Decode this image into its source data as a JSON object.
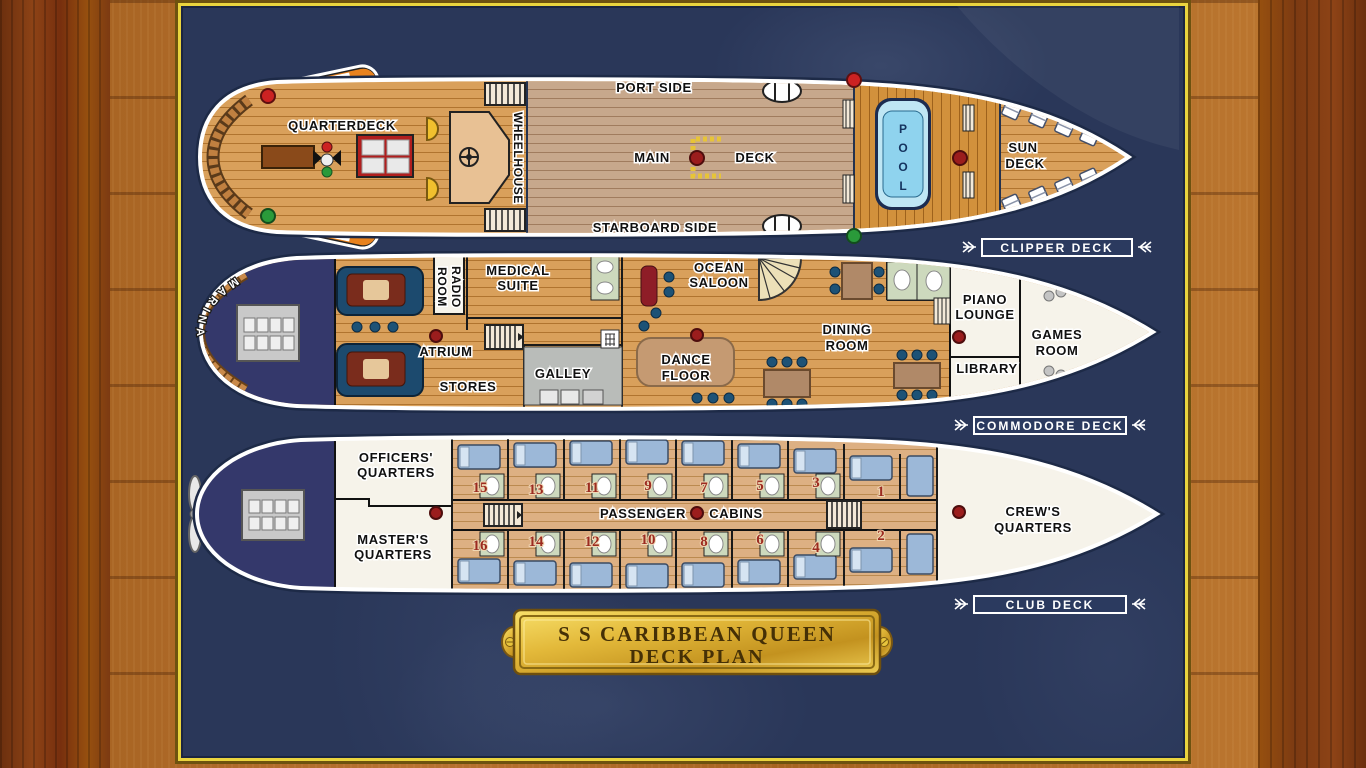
{
  "plaque": {
    "line1": "S S CARIBBEAN QUEEN",
    "line2": "DECK PLAN"
  },
  "decks": {
    "clipper": {
      "tag": "CLIPPER DECK",
      "labels": {
        "quarterdeck": "QUARTERDECK",
        "wheelhouse": "WHEELHOUSE",
        "port_side": "PORT SIDE",
        "starboard_side": "STARBOARD SIDE",
        "main": "MAIN",
        "deck": "DECK",
        "pool": "POOL",
        "sun": "SUN",
        "sun2": "DECK",
        "lifeboat1": "LIFE",
        "lifeboat2": "BOAT"
      }
    },
    "commodore": {
      "tag": "COMMODORE DECK",
      "labels": {
        "marina": "MARINA",
        "radio": [
          "RADIO",
          "ROOM"
        ],
        "medical": [
          "MEDICAL",
          "SUITE"
        ],
        "atrium": "ATRIUM",
        "stores": "STORES",
        "galley": "GALLEY",
        "ocean_saloon": [
          "OCEAN",
          "SALOON"
        ],
        "dance_floor": [
          "DANCE",
          "FLOOR"
        ],
        "dining_room": [
          "DINING",
          "ROOM"
        ],
        "piano_lounge": [
          "PIANO",
          "LOUNGE"
        ],
        "library": "LIBRARY",
        "games_room": [
          "GAMES",
          "ROOM"
        ]
      }
    },
    "club": {
      "tag": "CLUB DECK",
      "labels": {
        "officers": [
          "OFFICERS'",
          "QUARTERS"
        ],
        "masters": [
          "MASTER'S",
          "QUARTERS"
        ],
        "passenger": "PASSENGER",
        "cabins": "CABINS",
        "crews": [
          "CREW'S",
          "QUARTERS"
        ]
      },
      "cabin_numbers": [
        "1",
        "2",
        "3",
        "4",
        "5",
        "6",
        "7",
        "8",
        "9",
        "10",
        "11",
        "12",
        "13",
        "14",
        "15",
        "16"
      ]
    }
  },
  "colors": {
    "sea_navy": "#2a3759",
    "frame_gold": "#ead43e",
    "deck_tan": "#d9a05b",
    "main_deck_gray": "#c7a88c",
    "pool_deck_orange": "#d2913c",
    "pool_blue": "#8fd3ee",
    "marker_red": "#9b1d1d",
    "nav_green": "#2a9a3a",
    "cabin_number_red": "#9c2b20",
    "hull_white": "#ffffff",
    "stern_indigo": "#34386b",
    "bed_blue": "#9cb8d8",
    "bath_green": "#cdd9bd"
  }
}
